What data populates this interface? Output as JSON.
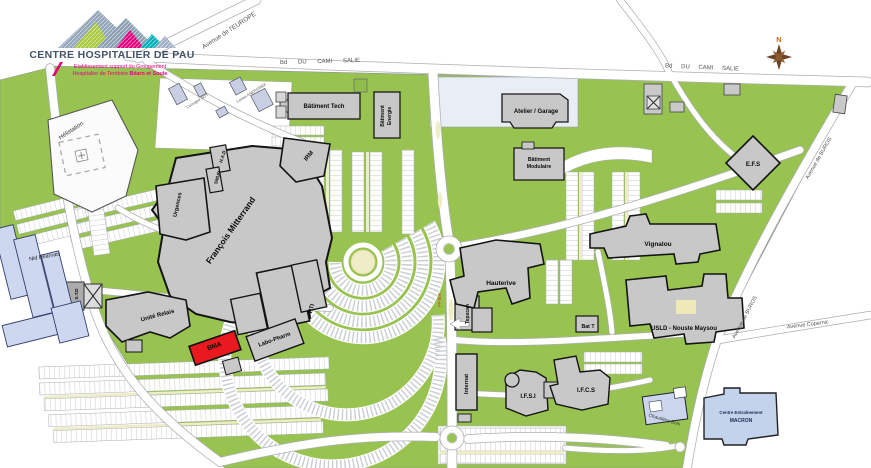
{
  "logo": {
    "title": "CENTRE HOSPITALIER DE PAU",
    "subtitle_line1": "Etablissement support du Groupement",
    "subtitle_line2_prefix": "Hospitalier de Territoire ",
    "subtitle_line2_bold": "Béarn et Soule"
  },
  "compass": {
    "north_label": "N"
  },
  "roads": {
    "avenue_europe": "Avenue de l'EUROPE",
    "bd_cami_salie_west": "Bd DU CAMI SALIE",
    "bd_cami_salie_east": "Bd DU CAMI SALIE",
    "avenue_buros_upper": "Avenue de BUROS",
    "avenue_buros_lower": "Avenue de BUROS",
    "avenue_copernic": "Avenue Copernic",
    "road_marker": "PP-805"
  },
  "buildings": {
    "helistation": {
      "label": "Hélistation"
    },
    "batiment_tech": {
      "label": "Bâtiment Tech"
    },
    "batiment_energie": {
      "line1": "Bâtiment",
      "line2": "Energie"
    },
    "atelier_garage": {
      "label": "Atelier / Garage"
    },
    "batiment_modulaire": {
      "line1": "Bâtiment",
      "line2": "Modulaire"
    },
    "irm": {
      "label": "IRM"
    },
    "had": {
      "label": "H.A.D"
    },
    "smur": {
      "label": "SMUR"
    },
    "urgences": {
      "label": "Urgences"
    },
    "francois_mitterrand": {
      "label": "François Mitterrand"
    },
    "nid_bearnais": {
      "label": "Nid Béarnais"
    },
    "std": {
      "label": "S.T.D"
    },
    "unite_relais": {
      "label": "Unité Relais"
    },
    "bma": {
      "label": "BMA"
    },
    "labo_pharm": {
      "label": "Labo-Pharm"
    },
    "pti": {
      "label": "PTI"
    },
    "tepscan": {
      "label": "Tepscan"
    },
    "hauterive": {
      "label": "Hauterive"
    },
    "vignalou": {
      "label": "Vignalou"
    },
    "bat_t": {
      "label": "Bat T"
    },
    "usld": {
      "label": "USLD - Nouste Maysou"
    },
    "efs": {
      "label": "E.F.S"
    },
    "internat": {
      "label": "Internat"
    },
    "ifsi": {
      "label": "I.F.S.I"
    },
    "ifcs": {
      "label": "I.F.C.S"
    },
    "chaudiere_bois": {
      "label": "Chaudière Bois"
    },
    "centre_macron": {
      "line1": "Centre Entraînement",
      "line2": "MACRON"
    },
    "consigne_boy": {
      "label": "Consigne BOY"
    },
    "centre_anergrief": {
      "label": "Centre ANERGRIEF"
    }
  },
  "colors": {
    "campus_green": "#99C351",
    "building_gray": "#C8C8C8",
    "building_outline": "#1A1A1A",
    "highlight_red": "#E8191F",
    "blue_building": "#CDD7EF",
    "paved_blue": "#E9EDF6",
    "parking_yellow": "#EFEDC5",
    "logo_pink": "#E5007D",
    "logo_teal": "#00AEB8",
    "logo_green": "#A9C93F",
    "logo_slate": "#44546A"
  }
}
